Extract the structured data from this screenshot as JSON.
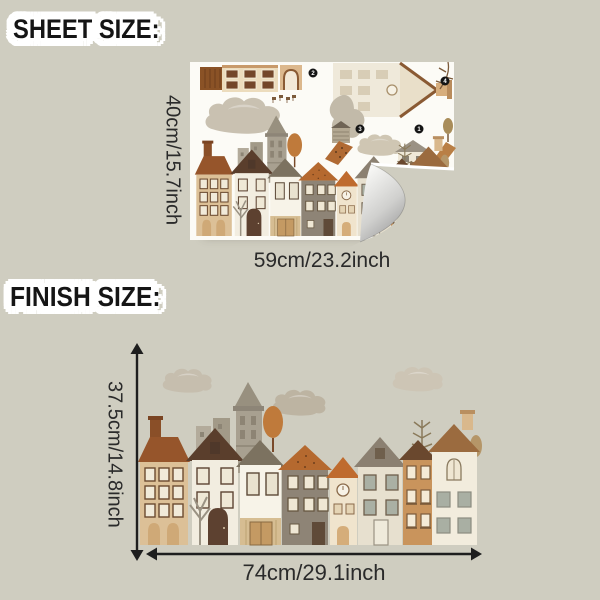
{
  "sheet": {
    "title": "SHEET SIZE:",
    "height_label": "40cm/15.7inch",
    "width_label": "59cm/23.2inch",
    "markers": [
      "2",
      "4",
      "3",
      "1"
    ]
  },
  "finish": {
    "title": "FINISH SIZE:",
    "height_label": "37.5cm/14.8inch",
    "width_label": "74cm/29.1inch"
  },
  "colors": {
    "background": "#cfcdc0",
    "sticker_outline": "#ffffff",
    "title_text": "#151515",
    "dimension_text": "#2a2a2a",
    "arrow": "#1e1e1e",
    "sheet_paper": "#fcfbf6",
    "curl_gradient_dark": "#848486",
    "house_palette": [
      "#dcc097",
      "#96552b",
      "#f2ede0",
      "#5a3e2c",
      "#f7f3e8",
      "#7c7260",
      "#8e8476",
      "#b5692f",
      "#f0e4cd",
      "#bf6b2e",
      "#e7e0cf",
      "#8b8071",
      "#c9945c",
      "#6a482e",
      "#f2ecdd",
      "#9b6b3f"
    ]
  }
}
